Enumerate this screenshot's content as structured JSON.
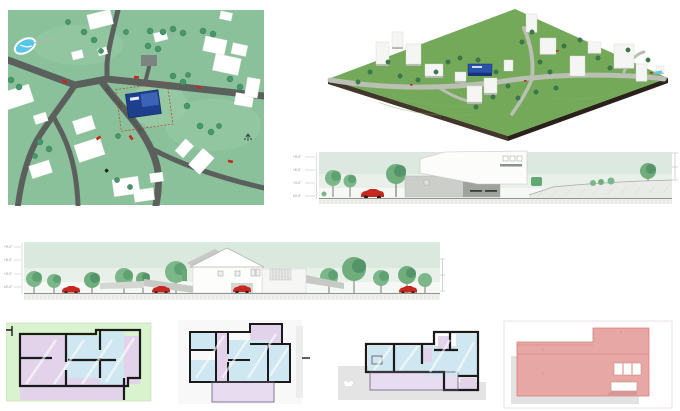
{
  "board": {
    "description": "architectural presentation board",
    "street_label": "BUILDING LOCATION"
  },
  "site_plan": {
    "street_label": "BUILDING LOCATION"
  },
  "elevation_right": {
    "levels": [
      "+9'-0\"",
      "+6'-0\"",
      "+3'-0\"",
      "±0'-0\""
    ]
  },
  "elevation_left": {
    "levels": [
      "+9'-0\"",
      "+6'-0\"",
      "+3'-0\"",
      "±0'-0\""
    ]
  },
  "colors": {
    "site_green": "#8ac09a",
    "terrain_green": "#75a95a",
    "subject_blue": "#1d3f8e",
    "road_gray": "#5b605d",
    "car_red": "#c8271e",
    "plan_room_blue": "#cfe7f1",
    "plan_room_lavender": "#e2d3eb",
    "plan_sheet_green": "#daf3cf",
    "roof_pink": "#e7a7a5",
    "elevation_sky_green": "#dce8e0"
  }
}
